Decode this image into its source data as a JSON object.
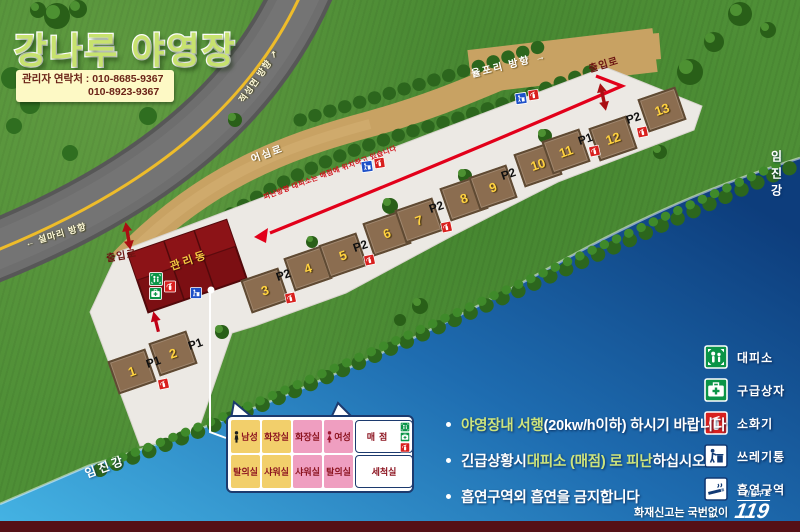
{
  "title": "강나루 야영장",
  "contact": {
    "label": "관리자 연락처 : 010-8685-9367",
    "phone2": "010-8923-9367"
  },
  "roads": {
    "up": {
      "text": "적성면 방향",
      "arrow": "↗"
    },
    "down": {
      "text": "설마리 방향",
      "arrow": "←"
    },
    "inner_path": "어심로",
    "top_path": {
      "text": "율포리 방향",
      "arrow": "→"
    }
  },
  "river_name": "임진강",
  "entrance_labels": [
    "출입로",
    "출입로"
  ],
  "building_label": "관리동",
  "evacuation_note": "피난방향 대피소는 매점에 위치하고 있습니다",
  "plots": [
    "1",
    "2",
    "3",
    "4",
    "5",
    "6",
    "7",
    "8",
    "9",
    "10",
    "11",
    "12",
    "13"
  ],
  "parking_labels": [
    "P1",
    "P1",
    "P2",
    "P2",
    "P2",
    "P2",
    "P1",
    "P2"
  ],
  "floor_plan": {
    "top_row": [
      "남성",
      "화장실",
      "화장실",
      "여성",
      "매점"
    ],
    "bottom_row": [
      "탈의실",
      "샤워실",
      "샤워실",
      "탈의실",
      "세척실"
    ]
  },
  "legend": [
    {
      "icon": "shelter-icon",
      "label": "대피소"
    },
    {
      "icon": "first-aid-icon",
      "label": "구급상자"
    },
    {
      "icon": "fire-extinguisher-icon",
      "label": "소화기"
    },
    {
      "icon": "trash-bin-icon",
      "label": "쓰레기통"
    },
    {
      "icon": "smoking-area-icon",
      "label": "흡연구역"
    }
  ],
  "notices": [
    {
      "pre": "",
      "highlight": "야영장내 서행",
      "post": " (20kw/h이하) 하시기 바랍니다"
    },
    {
      "pre": "긴급상황시 ",
      "highlight": "대피소 (매점) 로 피난",
      "post": "하십시오"
    },
    {
      "pre": "흡연구역외 흡연을 금지합니다",
      "highlight": "",
      "post": ""
    }
  ],
  "footer": {
    "fire_report": "화재신고는 국번없이",
    "rescue": "긴급구조",
    "number": "119"
  },
  "colors": {
    "route_red": "#e2001a",
    "building_red": "#801014",
    "grass_green": "#4e8f36",
    "river_light": "#45b4e4",
    "river_dark": "#0d3d7c",
    "legend_green": "#0a9447",
    "extinguisher_red": "#d8201e",
    "trash_blue": "#1d50c8",
    "highlight_text": "#cde47c"
  }
}
